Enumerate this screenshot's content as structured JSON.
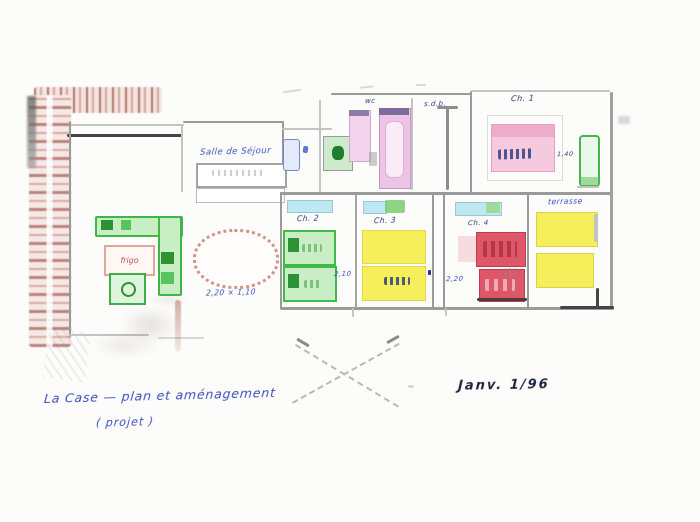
{
  "plan": {
    "living_room_label": "Salle de Séjour",
    "fridge_label": "frigo",
    "table_note": "2,20 × 1,10",
    "bath_label_wc": "wc",
    "bath_label_sdb": "s.d.b.",
    "bedroom_topright_label": "Ch. 1",
    "bed_note_topright": "1,40",
    "bedroom_green_label": "Ch. 2",
    "bedroom_yellow_label": "Ch. 3",
    "bedroom_red_label": "Ch. 4",
    "terrace_label": "terrasse",
    "dim_green_room": "2,10",
    "dim_red_room": "2,20",
    "caption_line1": "La Case — plan et aménagement",
    "caption_line2": "( projet )",
    "date_note": "Janv. 1/96"
  },
  "colors": {
    "paper": "#fcfcfb",
    "pencil": "#9a9a9a",
    "brick": "#b5746a",
    "ink_blue": "#3a4fbe",
    "ink_navy": "#27357e",
    "kitchen_green": "#43b447",
    "bed_green": "#c9eec5",
    "bed_yellow": "#f4ef5a",
    "bed_red": "#dd5768",
    "tub_pink": "#eec4e6",
    "window_cyan": "#bfe9f2",
    "table_terracotta": "#d29484"
  }
}
